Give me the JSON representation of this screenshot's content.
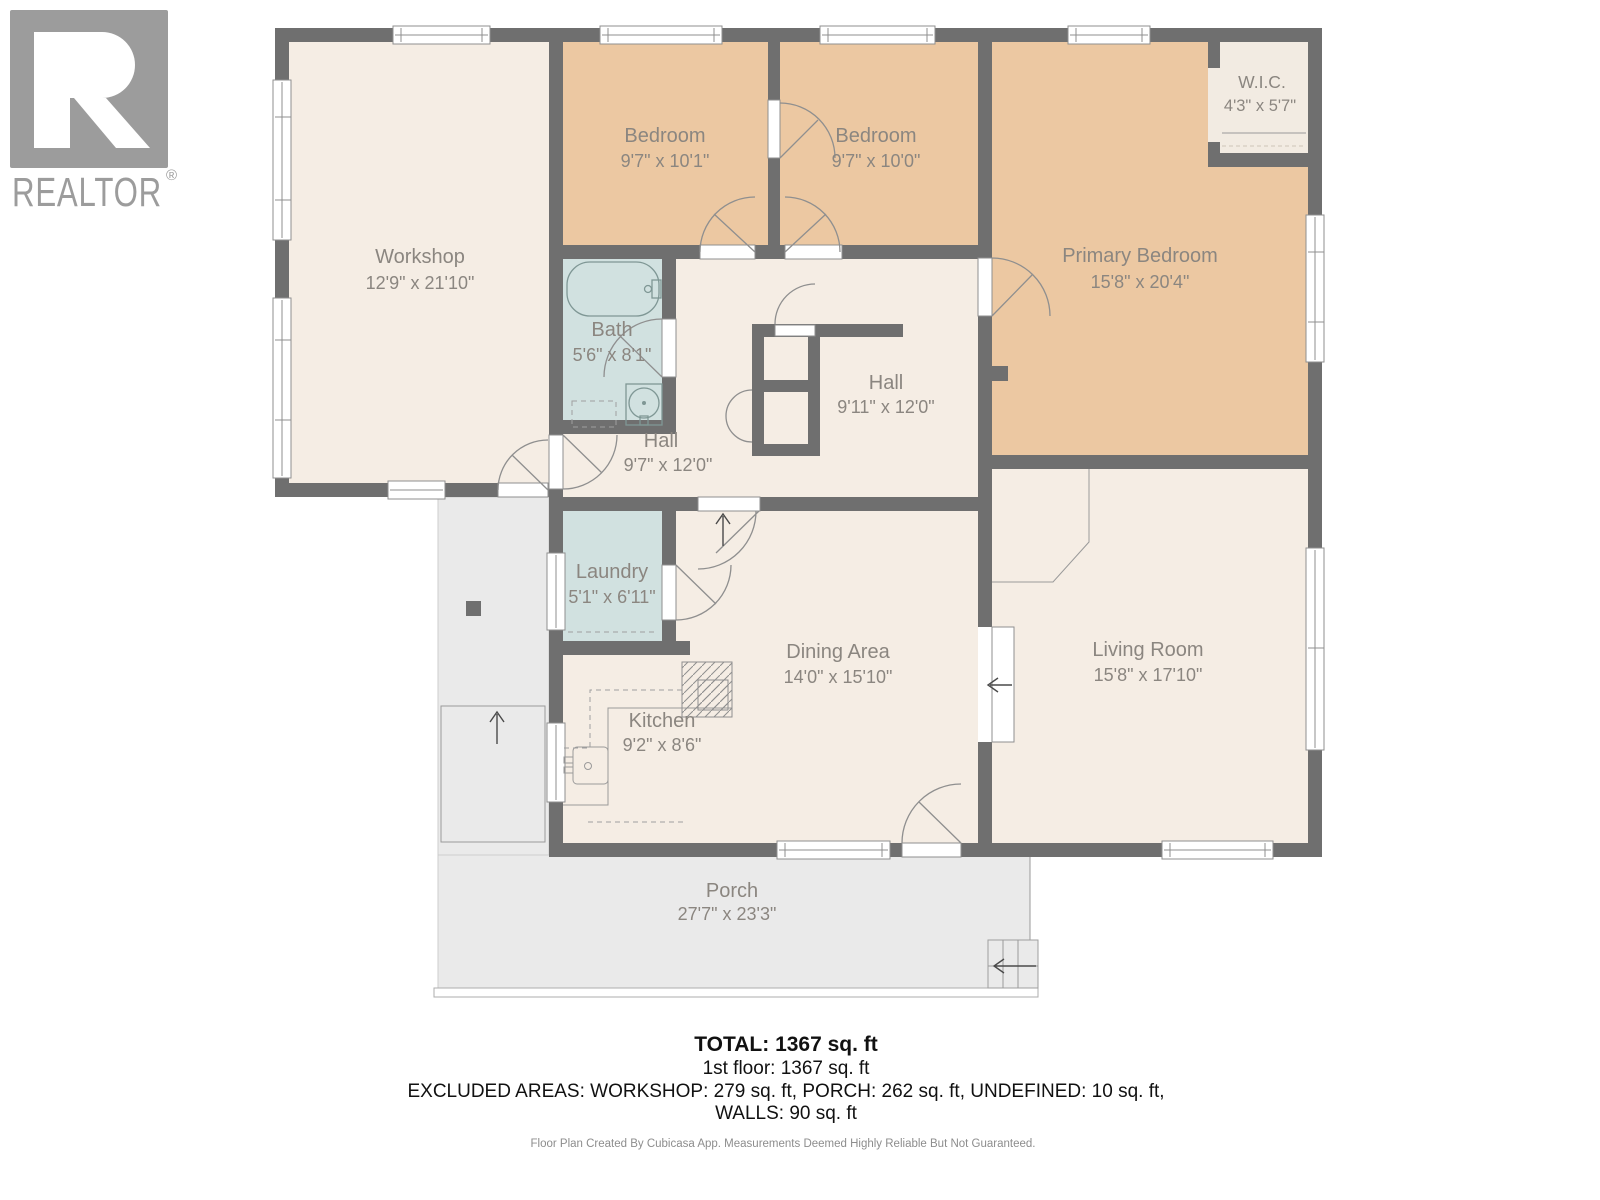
{
  "logo": {
    "brand": "REALTOR",
    "reg": "®"
  },
  "colors": {
    "wall": "#6f6f6f",
    "floor_cream": "#f5ede4",
    "floor_bedroom": "#ecc8a2",
    "floor_wet": "#d1e1e0",
    "floor_wic": "#f2ebe2",
    "porch": "#eaeaea",
    "label_text": "#8b8680"
  },
  "rooms": [
    {
      "name": "Workshop",
      "dims": "12'9\" x 21'10\""
    },
    {
      "name": "Bedroom",
      "dims": "9'7\" x 10'1\""
    },
    {
      "name": "Bedroom",
      "dims": "9'7\" x 10'0\""
    },
    {
      "name": "Primary Bedroom",
      "dims": "15'8\" x 20'4\""
    },
    {
      "name": "W.I.C.",
      "dims": "4'3\" x 5'7\""
    },
    {
      "name": "Bath",
      "dims": "5'6\" x 8'1\""
    },
    {
      "name": "Hall",
      "dims": "9'11\" x 12'0\""
    },
    {
      "name": "Hall",
      "dims": "9'7\" x 12'0\""
    },
    {
      "name": "Laundry",
      "dims": "5'1\" x 6'11\""
    },
    {
      "name": "Dining Area",
      "dims": "14'0\" x 15'10\""
    },
    {
      "name": "Kitchen",
      "dims": "9'2\" x 8'6\""
    },
    {
      "name": "Living Room",
      "dims": "15'8\" x 17'10\""
    },
    {
      "name": "Porch",
      "dims": "27'7\" x 23'3\""
    }
  ],
  "summary": {
    "total": "TOTAL: 1367 sq. ft",
    "first_floor": "1st floor: 1367 sq. ft",
    "excluded": "EXCLUDED AREAS: WORKSHOP: 279 sq. ft, PORCH: 262 sq. ft, UNDEFINED: 10 sq. ft,",
    "walls": "WALLS: 90 sq. ft"
  },
  "footer": {
    "note": "Floor Plan Created By Cubicasa App. Measurements Deemed Highly Reliable But Not Guaranteed."
  }
}
